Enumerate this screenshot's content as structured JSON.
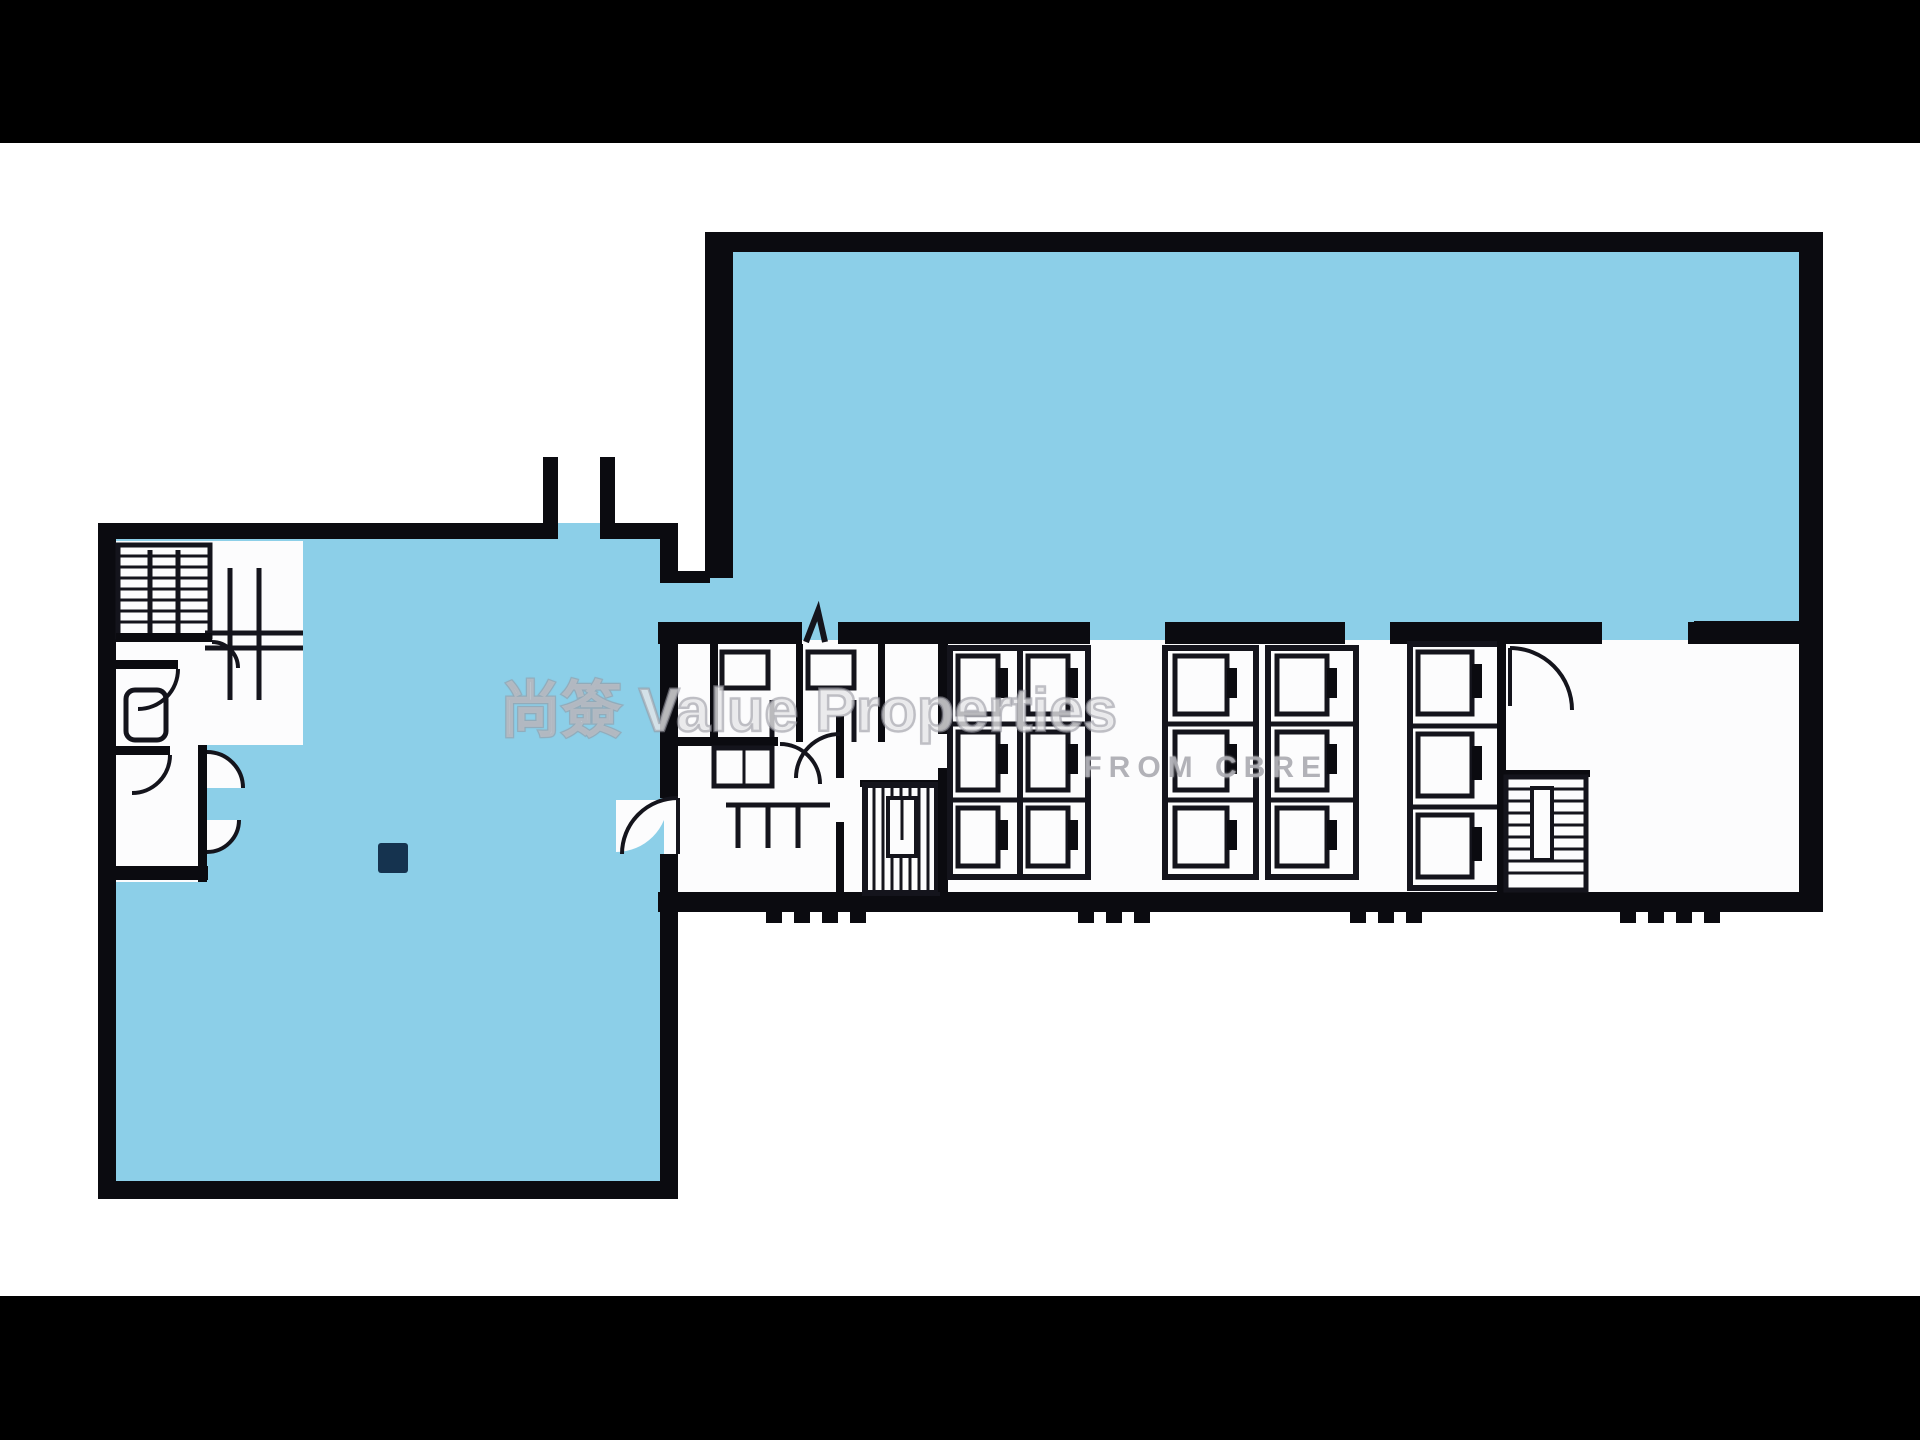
{
  "watermark": {
    "line1": "尚簽 Value Properties",
    "line2": "FROM CBRE"
  },
  "colors": {
    "letterbox": "#000000",
    "background": "#ffffff",
    "paper": "#fcfcfd",
    "area_fill": "#8ccfe8",
    "wall": "#0b0b10",
    "line": "#14141c",
    "column": "#15334f",
    "watermark_fill": "rgba(255,255,255,0.62)",
    "watermark_stroke": "rgba(152,152,160,0.55)",
    "watermark_sub": "rgba(165,165,172,0.85)"
  }
}
